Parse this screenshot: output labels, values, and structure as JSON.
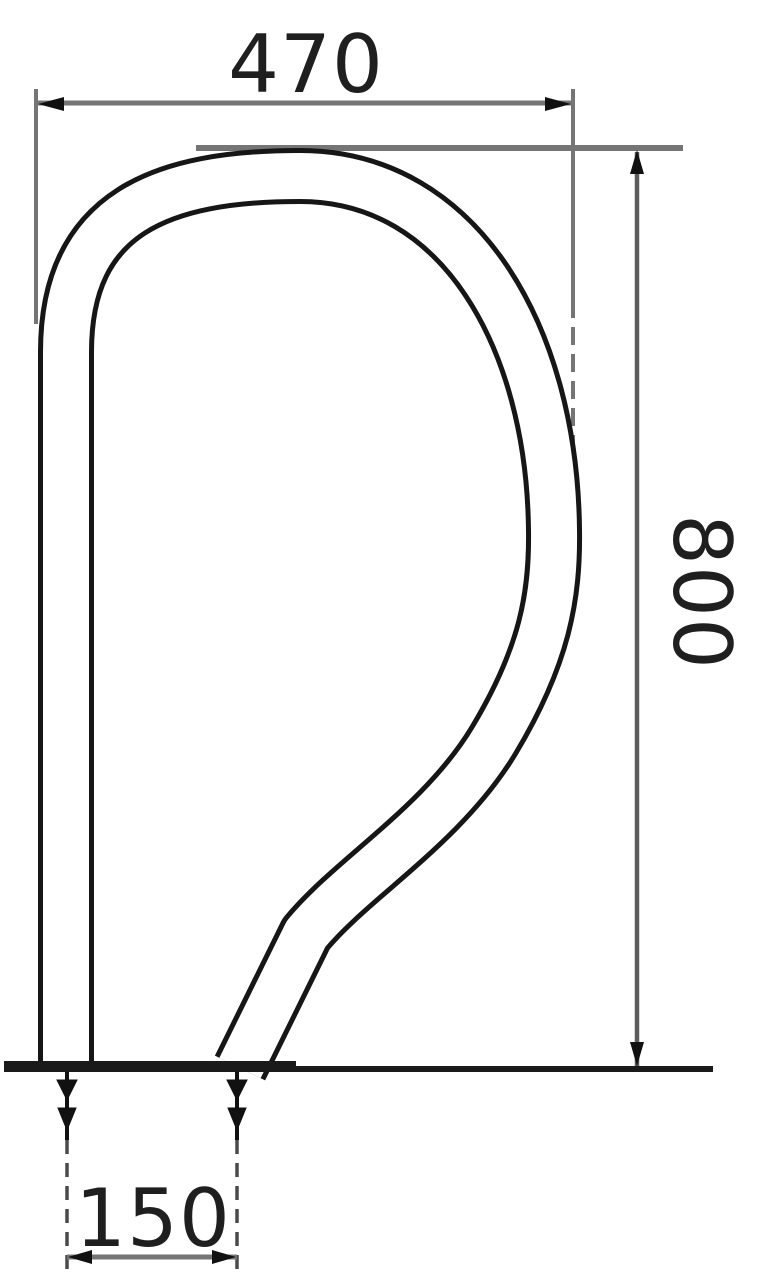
{
  "drawing": {
    "type": "technical-drawing",
    "subject": "curved-grab-rail-side-view",
    "dimensions": {
      "width": {
        "value": "470"
      },
      "height": {
        "value": "800"
      },
      "base_spacing": {
        "value": "150"
      }
    },
    "colors": {
      "outline": "#161616",
      "dimension_line": "#757575",
      "arrow": "#111111",
      "text": "#1f1f1f",
      "background": "#ffffff"
    }
  }
}
